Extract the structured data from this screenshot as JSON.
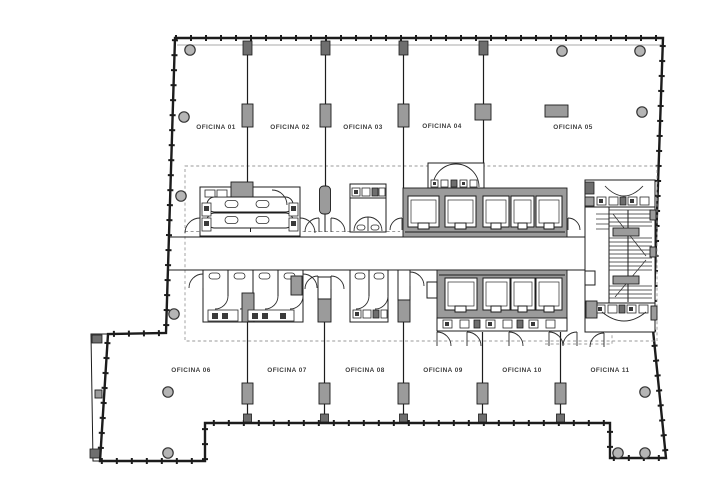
{
  "offices": [
    {
      "label": "OFICINA 01"
    },
    {
      "label": "OFICINA 02"
    },
    {
      "label": "OFICINA 03"
    },
    {
      "label": "OFICINA 04"
    },
    {
      "label": "OFICINA 05"
    },
    {
      "label": "OFICINA 06"
    },
    {
      "label": "OFICINA 07"
    },
    {
      "label": "OFICINA 08"
    },
    {
      "label": "OFICINA 09"
    },
    {
      "label": "OFICINA 10"
    },
    {
      "label": "OFICINA 11"
    }
  ],
  "colors": {
    "wall": "#1c1c1c",
    "column_fill": "#9b9b9b",
    "dark_column_fill": "#6e6e6e",
    "dashed_line": "#9a9a9a",
    "label_text": "#3d3d3d",
    "background": "#ffffff"
  }
}
